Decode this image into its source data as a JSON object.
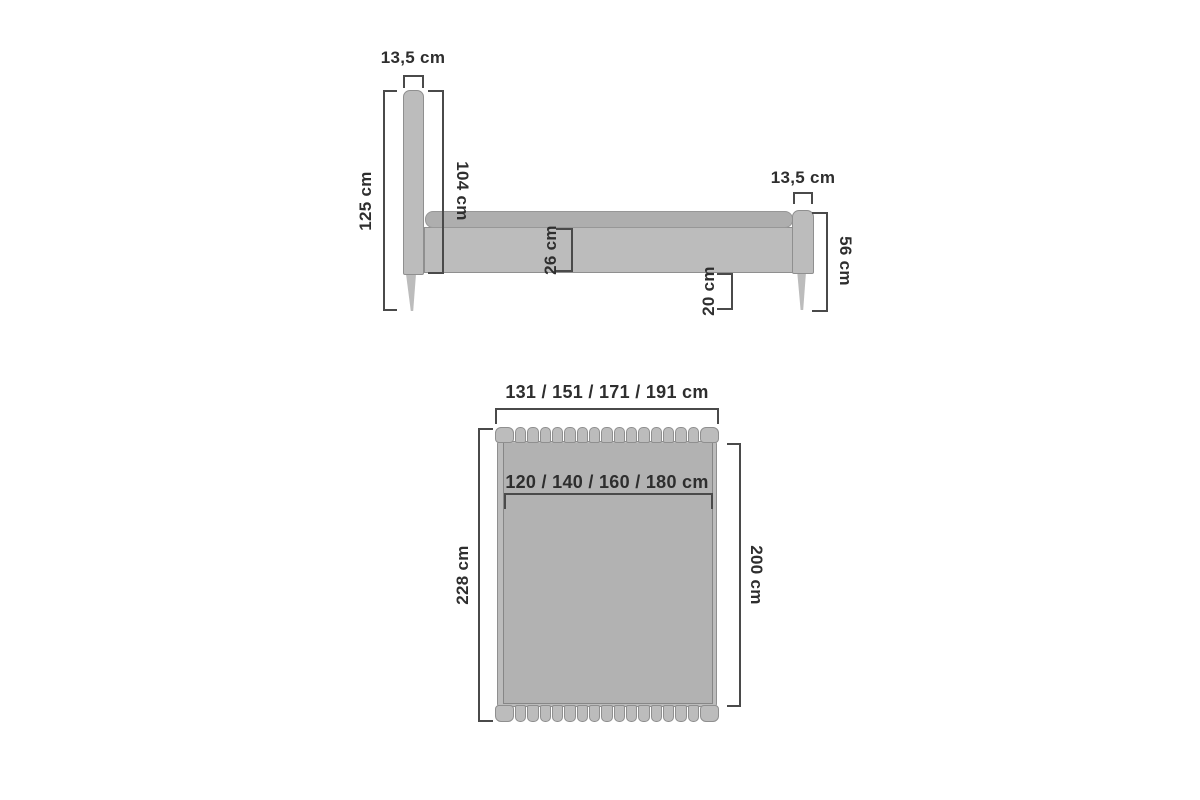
{
  "labels": {
    "headboard_width": "13,5 cm",
    "total_height": "125 cm",
    "headboard_height": "104 cm",
    "frame_height": "26 cm",
    "floor_clearance": "20 cm",
    "footboard_width": "13,5 cm",
    "footboard_height": "56 cm",
    "total_width": "131 / 151 / 171 / 191 cm",
    "mattress_width": "120 / 140 / 160 / 180 cm",
    "total_length": "228 cm",
    "mattress_length": "200 cm"
  },
  "colors": {
    "background": "#ffffff",
    "bed_fill": "#bcbcbc",
    "mattress_fill": "#b2b2b2",
    "strip_fill": "#aeaeae",
    "outline": "#8f8f8f",
    "dimension_line": "#4a4a4a",
    "text": "#2e2e2e"
  },
  "slat_count": 17
}
